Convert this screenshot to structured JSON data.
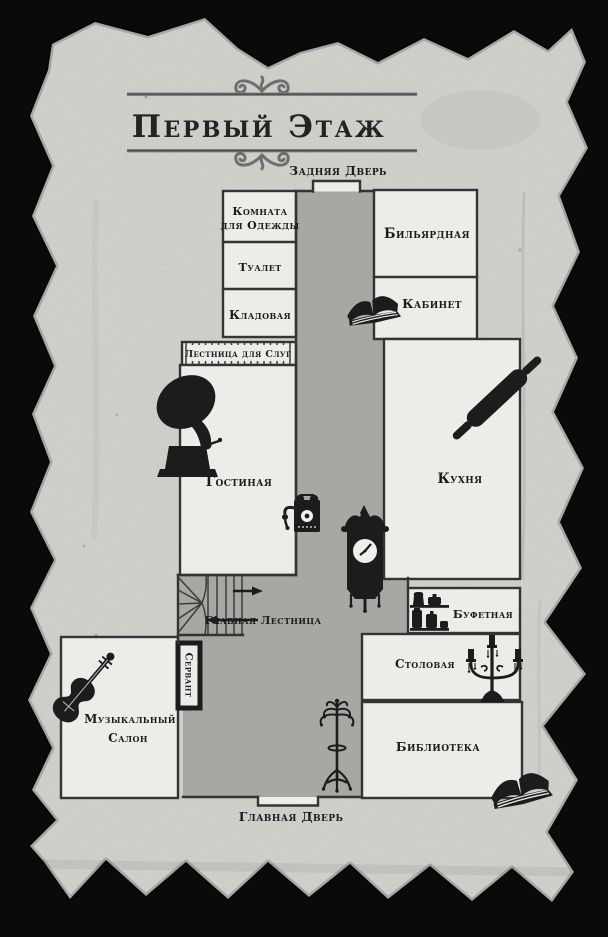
{
  "palette": {
    "bg": "#0a0a0a",
    "paper": "#dfddd8",
    "room": "#eeece8",
    "corridor": "#a8a7a3",
    "wall": "#343434",
    "ink": "#1c1c1c",
    "rule": "#6f6f6f",
    "stairline": "#3c3c3c",
    "facewhite": "#f0efec"
  },
  "title": {
    "text": "Первый Этаж"
  },
  "doors": {
    "back": {
      "label": "Задняя Дверь"
    },
    "main": {
      "label": "Главная Дверь"
    }
  },
  "rooms": {
    "cloakroom": {
      "line1": "Комната",
      "line2": "для Одежды"
    },
    "toilet": {
      "label": "Туалет"
    },
    "pantry": {
      "label": "Кладовая"
    },
    "billiard": {
      "label": "Бильярдная"
    },
    "study": {
      "label": "Кабинет"
    },
    "servants_stairs": {
      "label": "Лестница для Слуг"
    },
    "living_room": {
      "label": "Гостиная"
    },
    "kitchen": {
      "label": "Кухня"
    },
    "main_stairs": {
      "label": "Главная Лестница"
    },
    "buttery": {
      "label": "Буфетная"
    },
    "dining": {
      "label": "Столовая"
    },
    "sideboard": {
      "label": "Сервант"
    },
    "music_salon": {
      "line1": "Музыкальный",
      "line2": "Салон"
    },
    "library": {
      "label": "Библиотека"
    }
  },
  "icons": {
    "study_book": "open-book-icon",
    "library_book": "open-book-icon",
    "gramophone": "gramophone-icon",
    "rolling_pin": "rolling-pin-icon",
    "telephone": "wall-telephone-icon",
    "clock": "wall-clock-icon",
    "jug_shelf": "jug-shelf-icon",
    "candelabra": "candelabra-icon",
    "violin": "violin-icon",
    "coat_rack": "coat-rack-icon"
  }
}
